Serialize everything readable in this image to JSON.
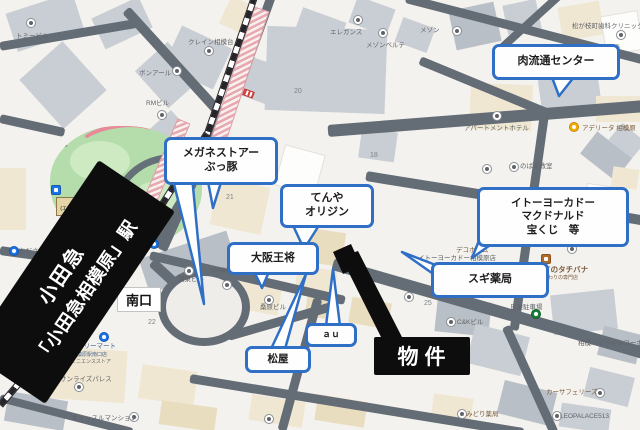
{
  "colors": {
    "callout_border": "#2f6fc6",
    "banner_bg": "#0d0d0d",
    "road": "#646c75",
    "park_green": "#b5ddab",
    "platform_pink": "#e6a9af"
  },
  "callouts": [
    {
      "id": "niku",
      "text": "肉流通センター"
    },
    {
      "id": "megane",
      "text": "メガネストアー\nぶっ豚"
    },
    {
      "id": "tenya",
      "text": "てんや\nオリジン"
    },
    {
      "id": "itoyokado",
      "text": "イトーヨーカドー\nマクドナルド\n宝くじ　等"
    },
    {
      "id": "sugi",
      "text": "スギ薬局"
    },
    {
      "id": "osaka",
      "text": "大阪王将"
    },
    {
      "id": "matsuya",
      "text": "松屋"
    },
    {
      "id": "au",
      "text": "ａｕ"
    }
  ],
  "property_label": "物件",
  "banner": {
    "line1": "小田急",
    "line2": "「小田急相模原」駅"
  },
  "exits": {
    "south": "南口",
    "north": "北口\n(エレベーター)"
  },
  "map_labels": [
    {
      "text": "トミービル"
    },
    {
      "text": "クレイン相模台"
    },
    {
      "text": "ボンアール"
    },
    {
      "text": "RMビル"
    },
    {
      "text": "エレガンス"
    },
    {
      "text": "メゾンベルテ"
    },
    {
      "text": "メゾン"
    },
    {
      "text": "松が枝町歯科クリニック"
    },
    {
      "text": "アパートメントホテル"
    },
    {
      "text": "アデリータ 相模原"
    },
    {
      "text": "のばえ教室"
    },
    {
      "text": "デコホーム"
    },
    {
      "text": "イトーヨーカドー相模原店"
    },
    {
      "text": "アイのタチバナ"
    },
    {
      "text": "こだわりの専門店"
    },
    {
      "text": "日栄駐車場"
    },
    {
      "text": "C&Kビル"
    },
    {
      "text": "相模ハイラインコーポ"
    },
    {
      "text": "カーサフェリーズ"
    },
    {
      "text": "LEOPALACE513"
    },
    {
      "text": "みどり薬局"
    },
    {
      "text": "ファミリーマート"
    },
    {
      "text": "小田急相模原駅南口店"
    },
    {
      "text": "コンビニエンスストア"
    },
    {
      "text": "サンライズパレス"
    },
    {
      "text": "キャッスルマンション"
    },
    {
      "text": "桑原ビル"
    },
    {
      "text": "湖東ビル"
    },
    {
      "text": "50R相模原"
    },
    {
      "text": "おださがプラザ"
    }
  ],
  "map_numbers": [
    {
      "text": "20"
    },
    {
      "text": "21"
    },
    {
      "text": "18"
    },
    {
      "text": "22"
    },
    {
      "text": "25"
    },
    {
      "text": "5"
    }
  ]
}
